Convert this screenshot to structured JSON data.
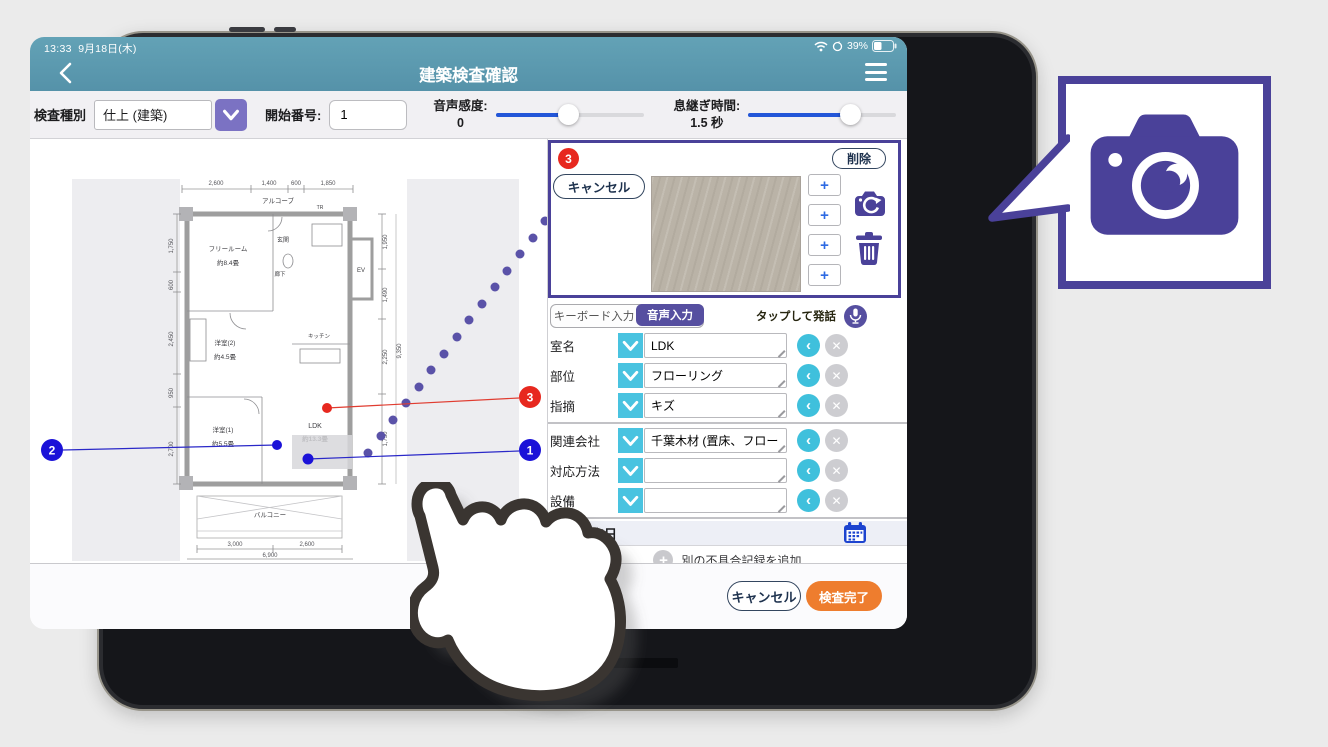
{
  "status_bar": {
    "time": "13:33",
    "date": "9月18日(木)",
    "battery_percent": "39%"
  },
  "header": {
    "title": "建築検査確認"
  },
  "toolbar": {
    "inspection_type_label": "検査種別",
    "inspection_type_value": "仕上 (建築)",
    "start_number_label": "開始番号:",
    "start_number_value": "1",
    "voice_sensitivity_label": "音声感度:",
    "voice_sensitivity_value": "0",
    "breath_time_label": "息継ぎ時間:",
    "breath_time_value": "1.5 秒"
  },
  "photo_panel": {
    "badge": "3",
    "delete_label": "削除",
    "cancel_label": "キャンセル",
    "plus_label": "+"
  },
  "input_mode": {
    "keyboard_tab": "キーボード入力",
    "voice_tab": "音声入力",
    "tap_to_speak": "タップして発話"
  },
  "fields": [
    {
      "label": "室名",
      "value": "LDK"
    },
    {
      "label": "部位",
      "value": "フローリング"
    },
    {
      "label": "指摘",
      "value": "キズ"
    },
    {
      "label": "関連会社",
      "value": "千葉木材 (置床、フローリン…"
    },
    {
      "label": "対応方法",
      "value": ""
    },
    {
      "label": "設備",
      "value": ""
    }
  ],
  "due_date_label": "完了予定日",
  "add_record": {
    "plus": "+",
    "label": "別の不具合記録を追加"
  },
  "footer": {
    "cancel_label": "キャンセル",
    "complete_label": "検査完了"
  },
  "floor_plan": {
    "markers": [
      {
        "id": "1",
        "color": "#1b12d8"
      },
      {
        "id": "2",
        "color": "#1b12d8"
      },
      {
        "id": "3",
        "color": "#e7281f"
      }
    ],
    "rooms": {
      "alcove": "アルコーブ",
      "tr": "TR",
      "free_room": "フリールーム",
      "free_room_size": "約8.4畳",
      "entrance": "玄関",
      "hallway": "廊下",
      "elevator": "EV",
      "bedroom2": "洋室(2)",
      "bedroom2_size": "約4.5畳",
      "bedroom1": "洋室(1)",
      "bedroom1_size": "約5.5畳",
      "kitchen": "キッチン",
      "ldk": "LDK",
      "ldk_size": "約13.3畳",
      "balcony": "バルコニー"
    },
    "dimensions_top": [
      "2,600",
      "1,400",
      "600",
      "1,850"
    ],
    "dimensions_bottom": [
      "3,000",
      "2,600",
      "6,900"
    ],
    "dimensions_left": [
      "1,750",
      "600",
      "2,450",
      "950",
      "2,700"
    ],
    "dimensions_right": [
      "1,950",
      "1,490",
      "2,250",
      "1,750",
      "9,350"
    ]
  },
  "icons": {
    "back": "‹",
    "clear": "✕",
    "undo": "‹",
    "plus": "+"
  },
  "colors": {
    "header_teal": "#5d9aaf",
    "accent_purple": "#4a4199",
    "tab_purple": "#564fa0",
    "button_purple": "#7b72c3",
    "cyan": "#49c3e0",
    "red": "#e7281f",
    "blue": "#1b12d8",
    "orange": "#ee7d2e",
    "slider_blue": "#2356d8"
  }
}
